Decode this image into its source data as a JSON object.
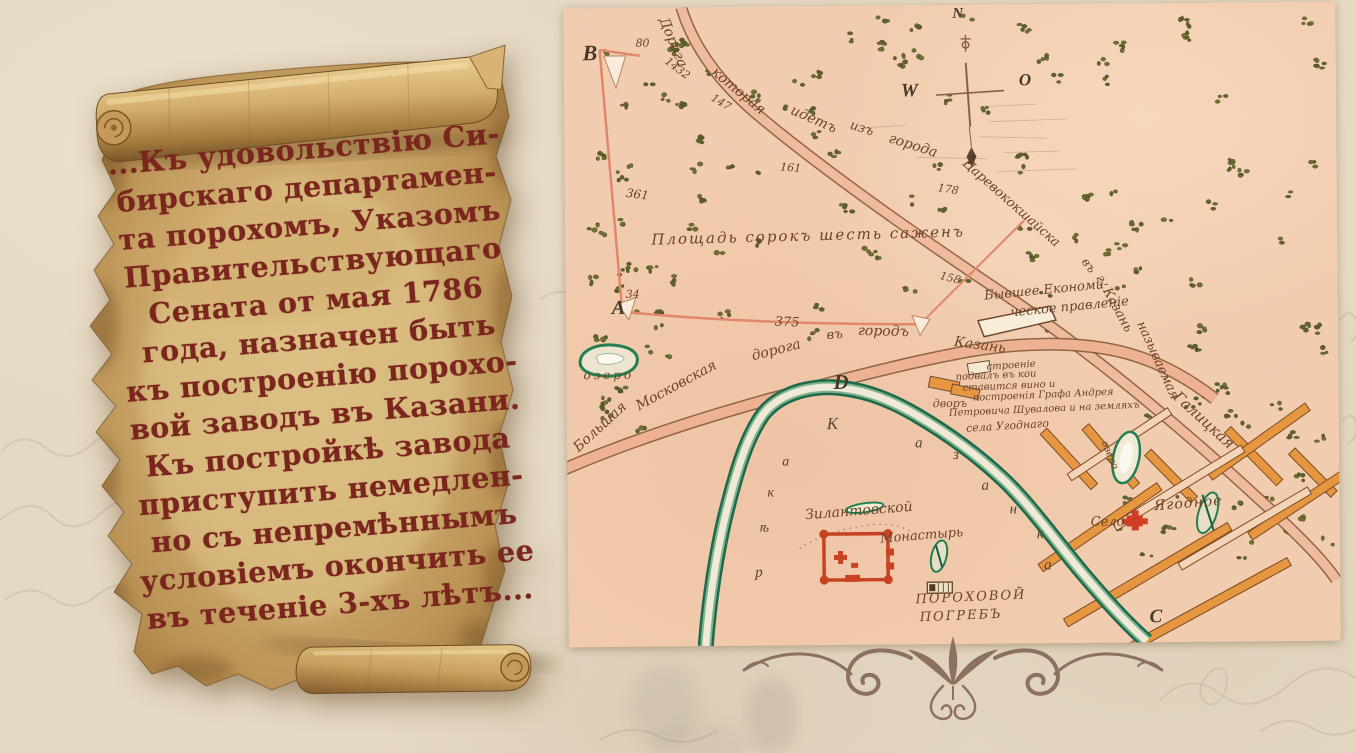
{
  "scroll": {
    "lines": [
      "...Къ удовольствію Си-",
      "бирскаго департамен-",
      "та порохомъ, Указомъ",
      "Правительствующаго",
      "Сената от мая 1786",
      "года, назначен быть",
      "къ построенію порохо-",
      "вой заводъ въ Казани.",
      "Къ постройкѣ завода",
      "приступить немедлен-",
      "но съ непремѣннымъ",
      "условіемъ окончить ее",
      "въ теченіе 3-хъ лѣтъ..."
    ]
  },
  "map": {
    "labels": [
      {
        "t": "В",
        "x": 19,
        "y": 34,
        "r": 0,
        "s": 22,
        "k": "letter"
      },
      {
        "t": "А",
        "x": 46,
        "y": 290,
        "r": 0,
        "s": 20,
        "k": "letter"
      },
      {
        "t": "D",
        "x": 267,
        "y": 366,
        "r": 0,
        "s": 21,
        "k": "letter"
      },
      {
        "t": "С",
        "x": 581,
        "y": 604,
        "r": 0,
        "s": 19,
        "k": "letter"
      },
      {
        "t": "W",
        "x": 337,
        "y": 76,
        "r": 0,
        "s": 19,
        "k": "letter"
      },
      {
        "t": "N",
        "x": 389,
        "y": 2,
        "r": 0,
        "s": 15,
        "k": "letter"
      },
      {
        "t": "O",
        "x": 455,
        "y": 67,
        "r": 0,
        "s": 17,
        "k": "letter"
      },
      {
        "t": "Z",
        "x": 403,
        "y": 148,
        "r": 0,
        "s": 13,
        "k": "letter"
      },
      {
        "t": "80",
        "x": 72,
        "y": 30,
        "r": 0,
        "s": 11,
        "k": "num"
      },
      {
        "t": "1432",
        "x": 106,
        "y": 48,
        "r": 38,
        "s": 11,
        "k": "num"
      },
      {
        "t": "147",
        "x": 151,
        "y": 85,
        "r": 32,
        "s": 11,
        "k": "num"
      },
      {
        "t": "361",
        "x": 62,
        "y": 179,
        "r": 8,
        "s": 12,
        "k": "num"
      },
      {
        "t": "161",
        "x": 216,
        "y": 155,
        "r": 5,
        "s": 11,
        "k": "num"
      },
      {
        "t": "178",
        "x": 374,
        "y": 177,
        "r": 10,
        "s": 11,
        "k": "num"
      },
      {
        "t": "34",
        "x": 60,
        "y": 281,
        "r": 0,
        "s": 11,
        "k": "num"
      },
      {
        "t": "375",
        "x": 209,
        "y": 309,
        "r": 3,
        "s": 13,
        "k": "num"
      },
      {
        "t": "158",
        "x": 376,
        "y": 265,
        "r": 15,
        "s": 11,
        "k": "num"
      },
      {
        "t": "Площадь сорокъ шесть саженъ",
        "x": 86,
        "y": 225,
        "r": -1,
        "s": 15,
        "ls": 2,
        "k": "hand"
      },
      {
        "t": "Дорога",
        "x": 106,
        "y": 8,
        "r": 68,
        "s": 14,
        "k": "hand"
      },
      {
        "t": "которая",
        "x": 154,
        "y": 58,
        "r": 40,
        "s": 14,
        "k": "hand"
      },
      {
        "t": "идетъ",
        "x": 230,
        "y": 97,
        "r": 24,
        "s": 14,
        "k": "hand"
      },
      {
        "t": "изъ",
        "x": 288,
        "y": 113,
        "r": 18,
        "s": 13,
        "k": "hand"
      },
      {
        "t": "города",
        "x": 327,
        "y": 126,
        "r": 18,
        "s": 14,
        "k": "hand"
      },
      {
        "t": "Царевококшайска",
        "x": 404,
        "y": 152,
        "r": 42,
        "s": 13,
        "k": "hand"
      },
      {
        "t": "въ",
        "x": 524,
        "y": 252,
        "r": 55,
        "s": 12,
        "k": "hand"
      },
      {
        "t": "г. Казань",
        "x": 539,
        "y": 269,
        "r": 62,
        "s": 13,
        "k": "hand"
      },
      {
        "t": "называемая",
        "x": 580,
        "y": 316,
        "r": 66,
        "s": 13,
        "k": "hand"
      },
      {
        "t": "Галицкая",
        "x": 614,
        "y": 386,
        "r": 43,
        "s": 15,
        "k": "hand"
      },
      {
        "t": "Большая",
        "x": 4,
        "y": 436,
        "r": -42,
        "s": 14,
        "k": "hand"
      },
      {
        "t": "Московская",
        "x": 67,
        "y": 393,
        "r": -28,
        "s": 14,
        "k": "hand"
      },
      {
        "t": "дорога",
        "x": 184,
        "y": 343,
        "r": -14,
        "s": 14,
        "k": "hand"
      },
      {
        "t": "въ",
        "x": 260,
        "y": 323,
        "r": -4,
        "s": 13,
        "k": "hand"
      },
      {
        "t": "городъ",
        "x": 292,
        "y": 318,
        "r": 2,
        "s": 14,
        "k": "hand"
      },
      {
        "t": "Казань",
        "x": 389,
        "y": 330,
        "r": 8,
        "s": 14,
        "k": "hand"
      },
      {
        "t": "озеро",
        "x": 17,
        "y": 361,
        "r": 0,
        "s": 12,
        "ls": 3,
        "k": "hand"
      },
      {
        "t": "Бывшее Економи-",
        "x": 418,
        "y": 285,
        "r": -5,
        "s": 13,
        "k": "hand"
      },
      {
        "t": "ческое правленіе",
        "x": 444,
        "y": 302,
        "r": -5,
        "s": 13,
        "k": "hand"
      },
      {
        "t": "строеніе",
        "x": 420,
        "y": 358,
        "r": -3,
        "s": 10,
        "k": "hand"
      },
      {
        "t": "подвалъ въ кои",
        "x": 389,
        "y": 368,
        "r": -2,
        "s": 10,
        "k": "hand"
      },
      {
        "t": "ставится вино и",
        "x": 396,
        "y": 379,
        "r": -2,
        "s": 10,
        "k": "hand"
      },
      {
        "t": "дворъ",
        "x": 366,
        "y": 393,
        "r": 0,
        "s": 11,
        "k": "hand"
      },
      {
        "t": "построенія Графа Андрея",
        "x": 406,
        "y": 389,
        "r": -2,
        "s": 10,
        "k": "hand"
      },
      {
        "t": "Петровича Шувалова и на земляхъ",
        "x": 382,
        "y": 404,
        "r": -2,
        "s": 10,
        "k": "hand"
      },
      {
        "t": "села Угоднаго",
        "x": 399,
        "y": 418,
        "r": -3,
        "s": 11,
        "k": "hand"
      },
      {
        "t": "Зилантовской",
        "x": 237,
        "y": 502,
        "r": -4,
        "s": 14,
        "k": "hand"
      },
      {
        "t": "Монастырь",
        "x": 312,
        "y": 527,
        "r": -4,
        "s": 13,
        "k": "hand"
      },
      {
        "t": "ПОРОХОВОЙ",
        "x": 347,
        "y": 588,
        "r": -2,
        "s": 13,
        "ls": 2,
        "k": "hand"
      },
      {
        "t": "ПОГРЕБЪ",
        "x": 351,
        "y": 606,
        "r": -2,
        "s": 13,
        "ls": 2,
        "k": "hand"
      },
      {
        "t": "Село",
        "x": 523,
        "y": 512,
        "r": 0,
        "s": 13,
        "k": "hand"
      },
      {
        "t": "Ягодное",
        "x": 586,
        "y": 496,
        "r": -4,
        "s": 14,
        "ls": 1,
        "k": "hand"
      },
      {
        "t": "озеро",
        "x": 541,
        "y": 436,
        "r": 68,
        "s": 10,
        "k": "hand"
      },
      {
        "t": "р",
        "x": 187,
        "y": 559,
        "r": 0,
        "s": 15,
        "k": "riv"
      },
      {
        "t": "ѣ",
        "x": 192,
        "y": 515,
        "r": 0,
        "s": 14,
        "k": "riv"
      },
      {
        "t": "к",
        "x": 200,
        "y": 480,
        "r": 0,
        "s": 14,
        "k": "riv"
      },
      {
        "t": "а",
        "x": 215,
        "y": 449,
        "r": 0,
        "s": 14,
        "k": "riv"
      },
      {
        "t": "К",
        "x": 260,
        "y": 409,
        "r": 0,
        "s": 17,
        "k": "riv"
      },
      {
        "t": "а",
        "x": 348,
        "y": 431,
        "r": 0,
        "s": 15,
        "k": "riv"
      },
      {
        "t": "з",
        "x": 386,
        "y": 443,
        "r": 0,
        "s": 15,
        "k": "riv"
      },
      {
        "t": "а",
        "x": 414,
        "y": 474,
        "r": 0,
        "s": 15,
        "k": "riv"
      },
      {
        "t": "н",
        "x": 442,
        "y": 498,
        "r": 0,
        "s": 15,
        "k": "riv"
      },
      {
        "t": "к",
        "x": 469,
        "y": 523,
        "r": 0,
        "s": 15,
        "k": "riv"
      },
      {
        "t": "а",
        "x": 476,
        "y": 554,
        "r": 0,
        "s": 15,
        "k": "riv"
      }
    ]
  },
  "colors": {
    "map_paper": "#f4ceb1",
    "road_fill": "#f0b394",
    "river_green": "#1f7e52",
    "monastery_red": "#c8401f",
    "street_orange": "#e8963f",
    "scroll_ink": "#7a251d",
    "ornament": "#8c7163",
    "map_ink": "#6b4427"
  }
}
